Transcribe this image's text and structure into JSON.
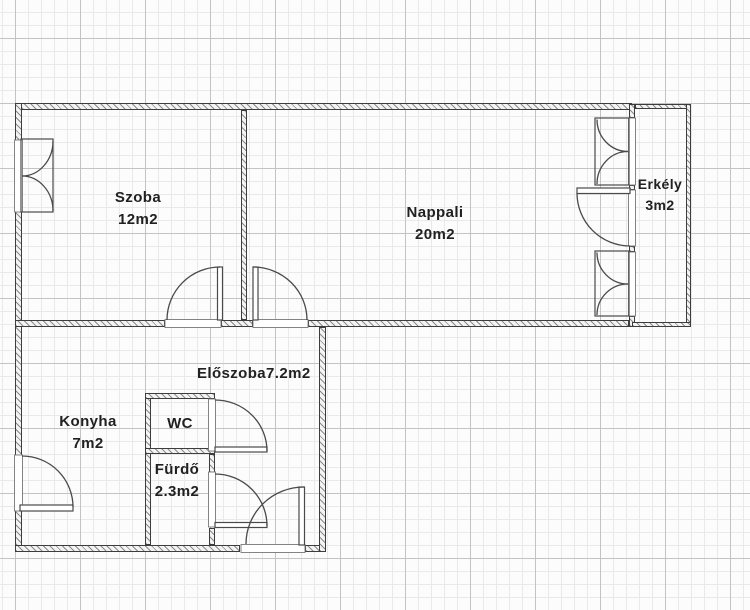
{
  "floorplan": {
    "title": "apartment floor plan",
    "units_suffix": "m2",
    "colors": {
      "background": "#fcfcfc",
      "grid_minor": "#e9e9e9",
      "grid_major": "#c3c3c3",
      "wall_edge": "#3d3d3d",
      "wall_hatch": "#8b8b8b",
      "label_text": "#212121",
      "symbol_stroke": "#4a4a4a"
    },
    "rooms": [
      {
        "id": "szoba",
        "name": "Szoba",
        "area": "12m2"
      },
      {
        "id": "nappali",
        "name": "Nappali",
        "area": "20m2"
      },
      {
        "id": "erkely",
        "name": "Erkély",
        "area": "3m2"
      },
      {
        "id": "eloszoba",
        "name": "Előszoba",
        "area": "7.2m2"
      },
      {
        "id": "konyha",
        "name": "Konyha",
        "area": "7m2"
      },
      {
        "id": "wc",
        "name": "WC",
        "area": ""
      },
      {
        "id": "furdo",
        "name": "Fürdő",
        "area": "2.3m2"
      }
    ]
  }
}
